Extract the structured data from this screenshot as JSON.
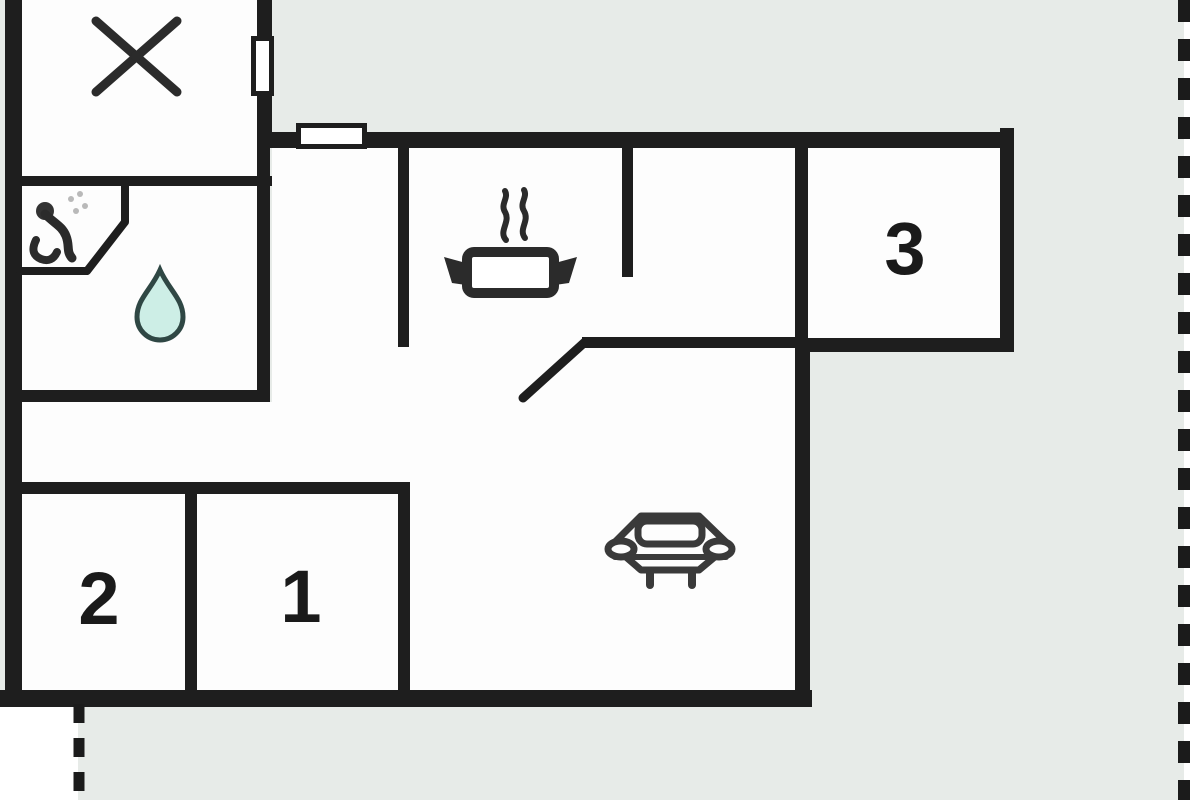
{
  "diagram": {
    "type": "floor-plan",
    "rooms": [
      {
        "id": "room-3",
        "label": "3"
      },
      {
        "id": "room-2",
        "label": "2"
      },
      {
        "id": "room-1",
        "label": "1"
      }
    ],
    "markers": [
      "x-marker-icon",
      "shower-icon",
      "water-drop-icon",
      "cooking-pot-icon",
      "sofa-icon",
      "door-swing-icon",
      "window-icon",
      "plot-boundary-dashed-line"
    ],
    "colors": {
      "plot_background": "#e7ebe8",
      "room_floor": "#fdfdfd",
      "wall": "#1e1e1e",
      "icon_dark": "#2b2b2b",
      "water_drop_fill": "#cdeee6",
      "water_drop_stroke": "#2f4744",
      "label_text": "#1a1a1a"
    }
  }
}
